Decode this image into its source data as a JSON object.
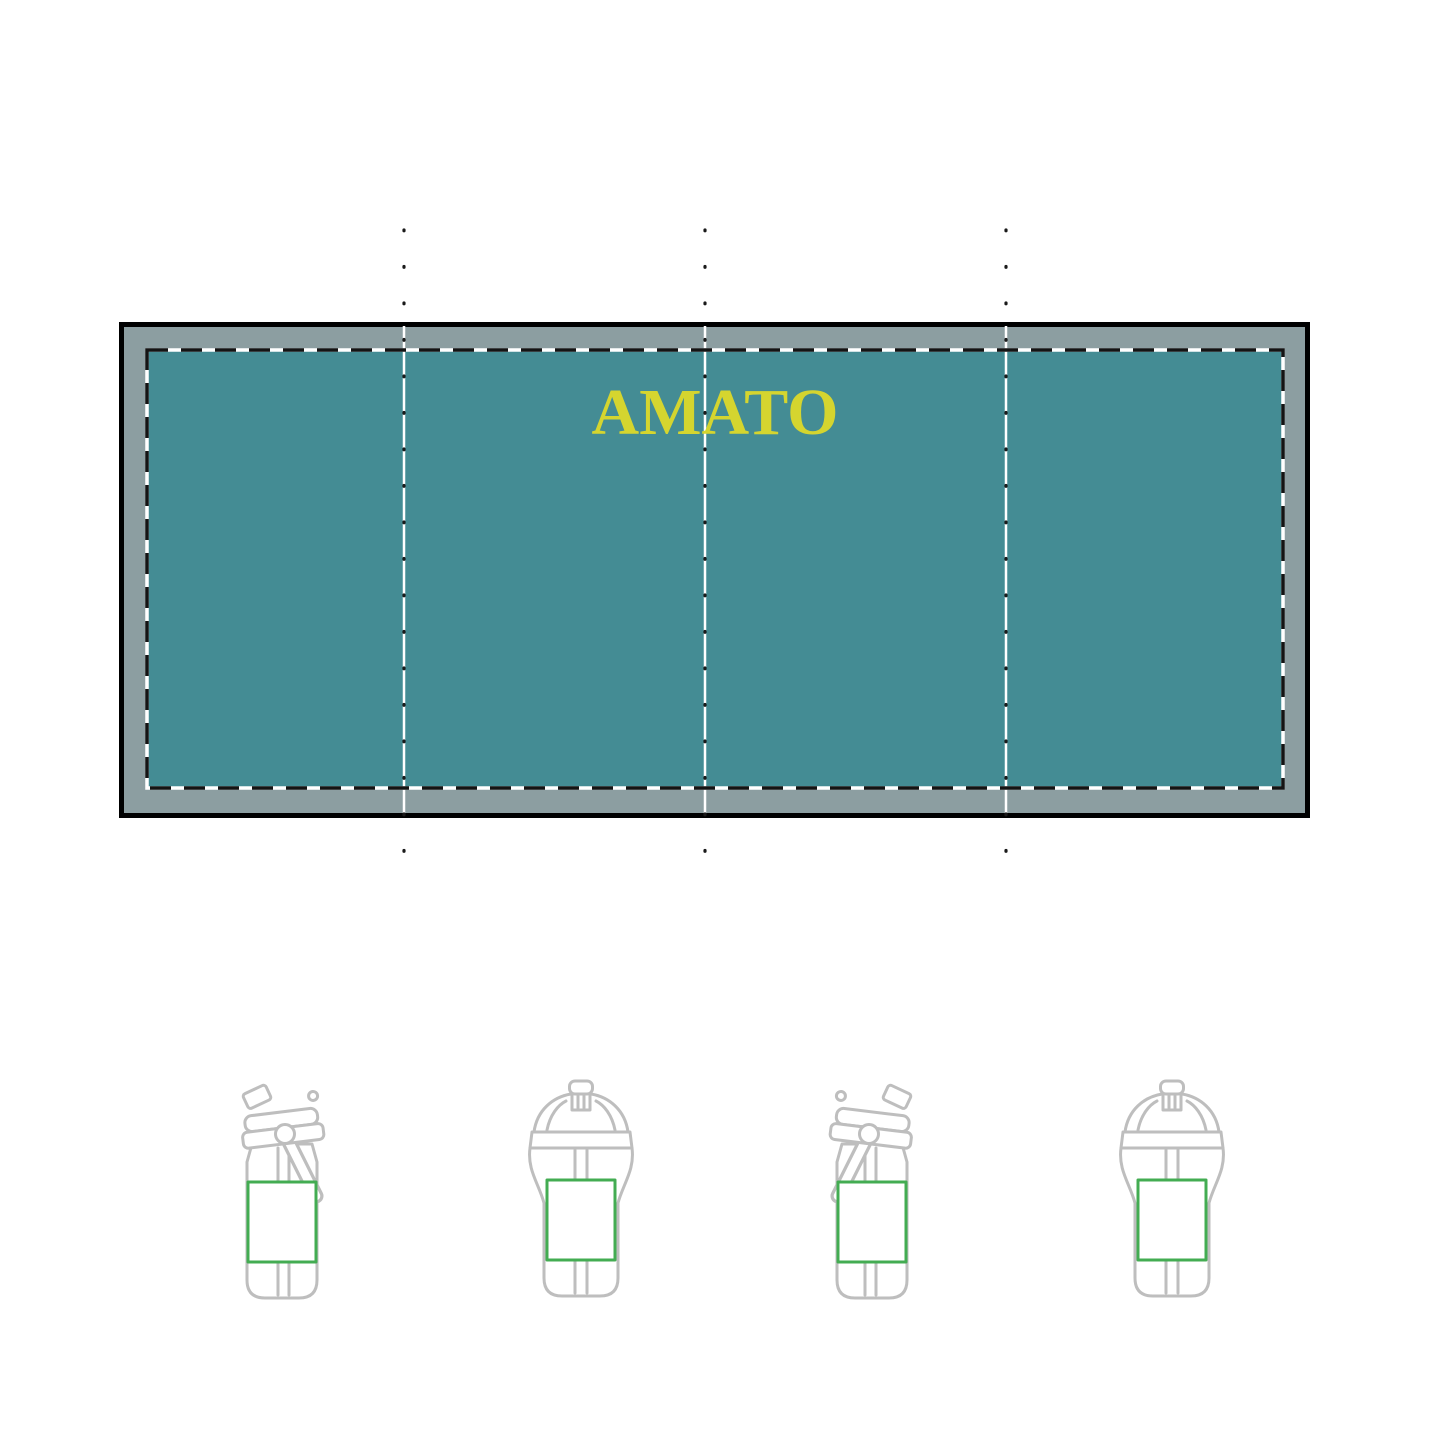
{
  "canvas": {
    "width": 1445,
    "height": 1445,
    "background": "#ffffff"
  },
  "proof": {
    "label_text": "AMATO",
    "panel_count": 4,
    "colors": {
      "panel_teal": "#448C94",
      "bleed_gray": "#8C9EA1",
      "outline_black": "#000000",
      "guide_dot_black": "#1a1a1a",
      "safe_area_white": "#ffffff",
      "label_yellow": "#D5D52F",
      "print_area_green": "#43AC52",
      "bottle_outline_gray": "#BEBEBE"
    }
  },
  "bottles": [
    {
      "icon": "flip-top-straw-bottle-handle-right-icon",
      "print_area": "green-box"
    },
    {
      "icon": "sport-spout-bottle-icon",
      "print_area": "green-box"
    },
    {
      "icon": "flip-top-straw-bottle-handle-left-icon",
      "print_area": "green-box"
    },
    {
      "icon": "sport-spout-bottle-icon",
      "print_area": "green-box"
    }
  ]
}
